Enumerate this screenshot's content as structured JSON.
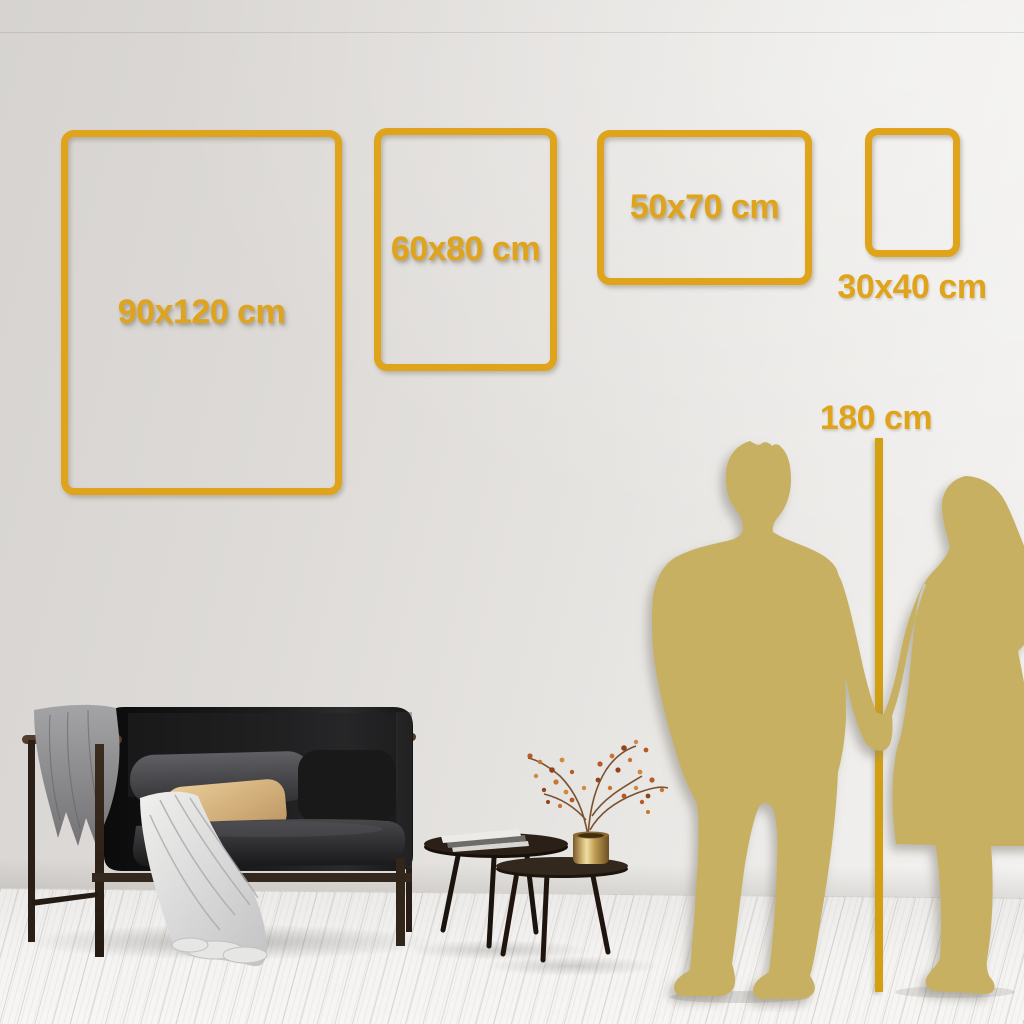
{
  "size_guide": {
    "unit": "cm",
    "frames": [
      {
        "label": "90x120 cm",
        "width_cm": 90,
        "height_cm": 120,
        "orientation": "portrait",
        "label_placement": "inside"
      },
      {
        "label": "60x80 cm",
        "width_cm": 60,
        "height_cm": 80,
        "orientation": "portrait",
        "label_placement": "inside"
      },
      {
        "label": "50x70 cm",
        "width_cm": 50,
        "height_cm": 70,
        "orientation": "landscape",
        "label_placement": "inside"
      },
      {
        "label": "30x40 cm",
        "width_cm": 30,
        "height_cm": 40,
        "orientation": "portrait",
        "label_placement": "below"
      }
    ],
    "height_reference": {
      "label": "180 cm",
      "height_cm": 180
    }
  },
  "colors": {
    "accent_gold": "#DFA41C",
    "line_gold": "#D3A011",
    "silhouette_gold": "#C7B062",
    "wall_mid": "#E2DFDC"
  }
}
